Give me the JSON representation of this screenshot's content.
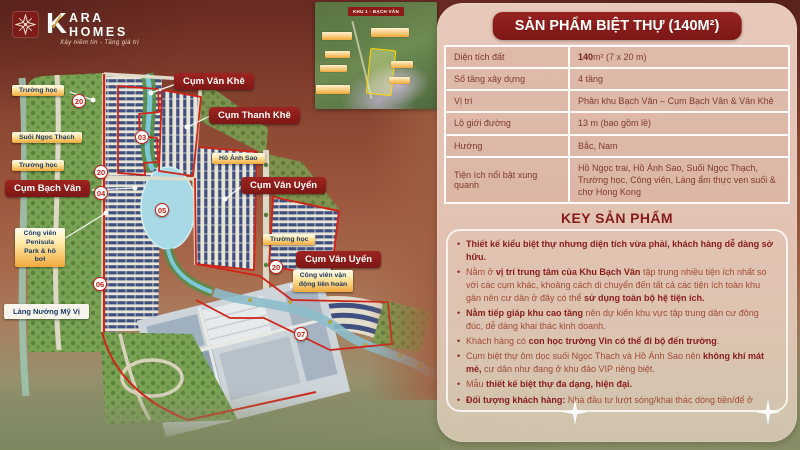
{
  "brand": {
    "k": "K",
    "top": "ARA",
    "bottom": "HOMES",
    "tagline": "Xây niềm tin - Tăng giá trị"
  },
  "panel": {
    "title": "SẢN PHẨM BIỆT THỰ (140M²)",
    "table": [
      {
        "label": "Diện tích đất",
        "value": [
          {
            "b": true,
            "t": "140"
          },
          {
            "t": "m² (7 x 20 m)"
          }
        ]
      },
      {
        "label": "Số tầng xây dựng",
        "value": [
          {
            "t": "4 tầng"
          }
        ]
      },
      {
        "label": "Vị trí",
        "value": [
          {
            "t": "Phân khu Bạch Vân – Cụm Bạch Vân & Vân Khê"
          }
        ]
      },
      {
        "label": "Lộ giới đường",
        "value": [
          {
            "t": "13 m (bao gồm lề)"
          }
        ]
      },
      {
        "label": "Hướng",
        "value": [
          {
            "t": "Bắc, Nam"
          }
        ]
      },
      {
        "label": "Tiện ích nổi bật xung quanh",
        "value": [
          {
            "t": "Hồ Ngọc trai, Hồ Ánh Sao, Suối Ngọc Thạch, Trường học, Công viên, Làng ẩm thực ven suối & chợ Hong Kong"
          }
        ]
      }
    ],
    "key_heading": "KEY SẢN PHẨM",
    "bullets": [
      [
        {
          "b": true,
          "t": "Thiết kế kiểu biệt thự nhưng diện tích vừa phải, khách hàng dễ dàng sở hữu."
        }
      ],
      [
        {
          "t": "Nằm ở "
        },
        {
          "b": true,
          "t": "vị trí trung tâm của Khu Bạch Vân"
        },
        {
          "t": " tập trung nhiều tiện ích nhất so với các cụm khác, khoảng cách di chuyển đến tất cả các tiện ích toàn khu gần nên cư dân ở đây có thể "
        },
        {
          "b": true,
          "t": "sử dụng toàn bộ hệ tiện ích."
        }
      ],
      [
        {
          "b": true,
          "t": "Nằm tiếp giáp khu cao tầng"
        },
        {
          "t": " nên dự kiến khu vực tập trung dân cư đông đúc, dễ dàng khai thác kinh doanh."
        }
      ],
      [
        {
          "t": "Khách hàng có "
        },
        {
          "b": true,
          "t": "con học trường Vin có thể đi bộ đến trường"
        },
        {
          "t": "."
        }
      ],
      [
        {
          "t": "Cụm biệt thự ôm dọc suối Ngọc Thạch và Hồ Ánh Sao nên "
        },
        {
          "b": true,
          "t": "không khí mát mẻ,"
        },
        {
          "t": " cư dân như đang ở khu đảo VIP riêng biệt."
        }
      ],
      [
        {
          "t": "Mẫu "
        },
        {
          "b": true,
          "t": "thiết kế biệt thự đa dạng, hiện đại."
        }
      ],
      [
        {
          "b": true,
          "t": "Đối tượng khách hàng:"
        },
        {
          "t": " Nhà đầu tư lướt sóng/khai thác dòng tiền/để ở"
        }
      ]
    ]
  },
  "map": {
    "labels": [
      {
        "text": "Trường học",
        "type": "gold",
        "x": 12,
        "y": 85
      },
      {
        "text": "Suối Ngọc Thạch",
        "type": "gold",
        "x": 12,
        "y": 132
      },
      {
        "text": "Trường học",
        "type": "gold",
        "x": 12,
        "y": 160
      },
      {
        "text": "Cụm Bạch Vân",
        "type": "red",
        "x": 5,
        "y": 180
      },
      {
        "text": "Cụm Vân Khê",
        "type": "red",
        "x": 174,
        "y": 73
      },
      {
        "text": "Cụm Thanh Khê",
        "type": "red",
        "x": 209,
        "y": 107
      },
      {
        "text": "Hồ Ánh Sao",
        "type": "gold",
        "x": 212,
        "y": 153
      },
      {
        "text": "Cụm Vân Uyển",
        "type": "red",
        "x": 241,
        "y": 177
      },
      {
        "text": "Trường học",
        "type": "gold",
        "x": 263,
        "y": 234
      },
      {
        "text": "Cụm Vân Uyển",
        "type": "red",
        "x": 296,
        "y": 251
      },
      {
        "text": "Công viên vận động liên hoàn",
        "type": "gold",
        "x": 293,
        "y": 270,
        "w": 60
      },
      {
        "text": "Công viên Penisula Park & hồ bơi",
        "type": "gold",
        "x": 15,
        "y": 228,
        "w": 50
      },
      {
        "text": "Làng Nướng Mỹ Vị",
        "type": "white",
        "x": 4,
        "y": 304
      }
    ],
    "badges": [
      {
        "n": "20",
        "x": 72,
        "y": 94
      },
      {
        "n": "03",
        "x": 135,
        "y": 130
      },
      {
        "n": "20",
        "x": 94,
        "y": 165
      },
      {
        "n": "04",
        "x": 94,
        "y": 186
      },
      {
        "n": "05",
        "x": 155,
        "y": 203
      },
      {
        "n": "20",
        "x": 269,
        "y": 260
      },
      {
        "n": "06",
        "x": 93,
        "y": 277
      },
      {
        "n": "07",
        "x": 294,
        "y": 327
      }
    ],
    "inset": {
      "title": "KHU 1 - BẠCH VÂN",
      "chips": [
        [
          7,
          30,
          30,
          8
        ],
        [
          10,
          49,
          25,
          7
        ],
        [
          5,
          63,
          27,
          7
        ],
        [
          1,
          83,
          34,
          9
        ],
        [
          56,
          26,
          38,
          9
        ],
        [
          76,
          59,
          22,
          7
        ],
        [
          74,
          75,
          21,
          7
        ]
      ]
    }
  },
  "colors": {
    "accent_maroon": "#871b1a",
    "gold_label": "#f1a93c",
    "red_outline": "#d02418",
    "panel_bg": "#e9cabb",
    "roof_navy": "#3f5080"
  }
}
